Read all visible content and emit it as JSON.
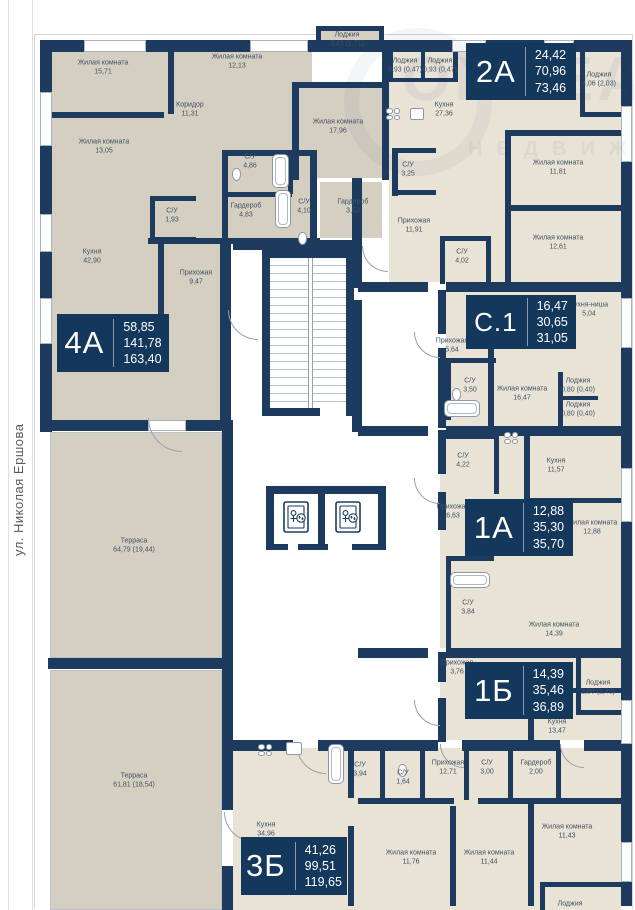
{
  "meta": {
    "street_label": "ул. Николая Ершова",
    "watermark_line1": "ONREAL",
    "watermark_line2": "НЕДВИЖИМОСТЬ"
  },
  "colors": {
    "wall": "#1d3b5e",
    "badge_bg": "#14375c",
    "room_tone_a": "#d5cfc2",
    "room_tone_b": "#e9e3d6",
    "label_text": "#3f5166"
  },
  "apartments": [
    {
      "label": "4А",
      "values": [
        "58,85",
        "141,78",
        "163,40"
      ],
      "x": 57,
      "y": 314,
      "w": 112,
      "h": 58
    },
    {
      "label": "2А",
      "values": [
        "24,42",
        "70,96",
        "73,46"
      ],
      "x": 466,
      "y": 43,
      "w": 110,
      "h": 57
    },
    {
      "label": "С.1",
      "values": [
        "16,47",
        "30,65",
        "31,05"
      ],
      "x": 466,
      "y": 295,
      "w": 110,
      "h": 54
    },
    {
      "label": "1А",
      "values": [
        "12,88",
        "35,30",
        "35,70"
      ],
      "x": 465,
      "y": 499,
      "w": 108,
      "h": 57
    },
    {
      "label": "1Б",
      "values": [
        "14,39",
        "35,46",
        "36,89"
      ],
      "x": 465,
      "y": 662,
      "w": 108,
      "h": 57
    },
    {
      "label": "3Б",
      "values": [
        "41,26",
        "99,51",
        "119,65"
      ],
      "x": 241,
      "y": 837,
      "w": 106,
      "h": 58
    }
  ],
  "rooms": [
    {
      "name": "Жилая комната",
      "area": "15,71",
      "x": 103,
      "y": 68
    },
    {
      "name": "Жилая комната",
      "area": "12,13",
      "x": 237,
      "y": 62
    },
    {
      "name": "Коридор",
      "area": "11,31",
      "x": 190,
      "y": 110
    },
    {
      "name": "Жилая комната",
      "area": "13,05",
      "x": 104,
      "y": 147
    },
    {
      "name": "С/У",
      "area": "4,86",
      "x": 250,
      "y": 162
    },
    {
      "name": "Гардероб",
      "area": "4,83",
      "x": 246,
      "y": 211
    },
    {
      "name": "С/У",
      "area": "1,93",
      "x": 172,
      "y": 216
    },
    {
      "name": "С/У",
      "area": "4,10",
      "x": 304,
      "y": 207
    },
    {
      "name": "Гардероб",
      "area": "3,53",
      "x": 353,
      "y": 207
    },
    {
      "name": "Кухня",
      "area": "42,90",
      "x": 92,
      "y": 257
    },
    {
      "name": "Прихожая",
      "area": "9,47",
      "x": 196,
      "y": 278
    },
    {
      "name": "Лоджия",
      "area": "3,43 (1,71)",
      "x": 347,
      "y": 40
    },
    {
      "name": "Жилая комната",
      "area": "17,96",
      "x": 338,
      "y": 127
    },
    {
      "name": "Лоджия",
      "area": "0,93 (0,47)",
      "x": 405,
      "y": 66
    },
    {
      "name": "Лоджия",
      "area": "0,93 (0,47)",
      "x": 440,
      "y": 66
    },
    {
      "name": "Кухня",
      "area": "27,36",
      "x": 444,
      "y": 110
    },
    {
      "name": "Лоджия",
      "area": "4,06 (2,03)",
      "x": 599,
      "y": 80
    },
    {
      "name": "С/У",
      "area": "3,25",
      "x": 408,
      "y": 170
    },
    {
      "name": "Жилая комната",
      "area": "11,81",
      "x": 558,
      "y": 168
    },
    {
      "name": "Прихожая",
      "area": "11,91",
      "x": 414,
      "y": 226
    },
    {
      "name": "Жилая комната",
      "area": "12,61",
      "x": 558,
      "y": 243
    },
    {
      "name": "С/У",
      "area": "4,02",
      "x": 462,
      "y": 257
    },
    {
      "name": "Кухня-ниша",
      "area": "5,04",
      "x": 589,
      "y": 310
    },
    {
      "name": "Прихожая",
      "area": "5,64",
      "x": 452,
      "y": 346
    },
    {
      "name": "С/У",
      "area": "3,50",
      "x": 470,
      "y": 386
    },
    {
      "name": "Жилая комната",
      "area": "16,47",
      "x": 522,
      "y": 394
    },
    {
      "name": "Лоджия",
      "area": "0,80 (0,40)",
      "x": 578,
      "y": 386
    },
    {
      "name": "Лоджия",
      "area": "0,80 (0,40)",
      "x": 578,
      "y": 410
    },
    {
      "name": "С/У",
      "area": "4,22",
      "x": 463,
      "y": 461
    },
    {
      "name": "Кухня",
      "area": "11,57",
      "x": 556,
      "y": 466
    },
    {
      "name": "Прихожая",
      "area": "6,63",
      "x": 453,
      "y": 512
    },
    {
      "name": "Жилая комната",
      "area": "12,88",
      "x": 592,
      "y": 528
    },
    {
      "name": "С/У",
      "area": "3,84",
      "x": 468,
      "y": 608
    },
    {
      "name": "Жилая комната",
      "area": "14,39",
      "x": 554,
      "y": 630
    },
    {
      "name": "Прихожая",
      "area": "3,76",
      "x": 457,
      "y": 668
    },
    {
      "name": "Лоджия",
      "area": "2,86 (1,43)",
      "x": 598,
      "y": 688
    },
    {
      "name": "Кухня",
      "area": "13,47",
      "x": 557,
      "y": 727
    },
    {
      "name": "С/У",
      "area": "3,94",
      "x": 360,
      "y": 770
    },
    {
      "name": "С/У",
      "area": "1,64",
      "x": 403,
      "y": 778
    },
    {
      "name": "Прихожая",
      "area": "12,71",
      "x": 448,
      "y": 768
    },
    {
      "name": "С/У",
      "area": "3,00",
      "x": 487,
      "y": 768
    },
    {
      "name": "Гардероб",
      "area": "2,00",
      "x": 536,
      "y": 768
    },
    {
      "name": "Кухня",
      "area": "34,96",
      "x": 266,
      "y": 830
    },
    {
      "name": "Жилая комната",
      "area": "11,76",
      "x": 411,
      "y": 858
    },
    {
      "name": "Жилая комната",
      "area": "11,44",
      "x": 489,
      "y": 858
    },
    {
      "name": "Жилая комната",
      "area": "11,43",
      "x": 567,
      "y": 832
    },
    {
      "name": "Лоджия",
      "area": "",
      "x": 570,
      "y": 904
    },
    {
      "name": "Терраса",
      "area": "64,79 (19,44)",
      "x": 134,
      "y": 546
    },
    {
      "name": "Терраса",
      "area": "61,81 (18,54)",
      "x": 134,
      "y": 781
    }
  ]
}
